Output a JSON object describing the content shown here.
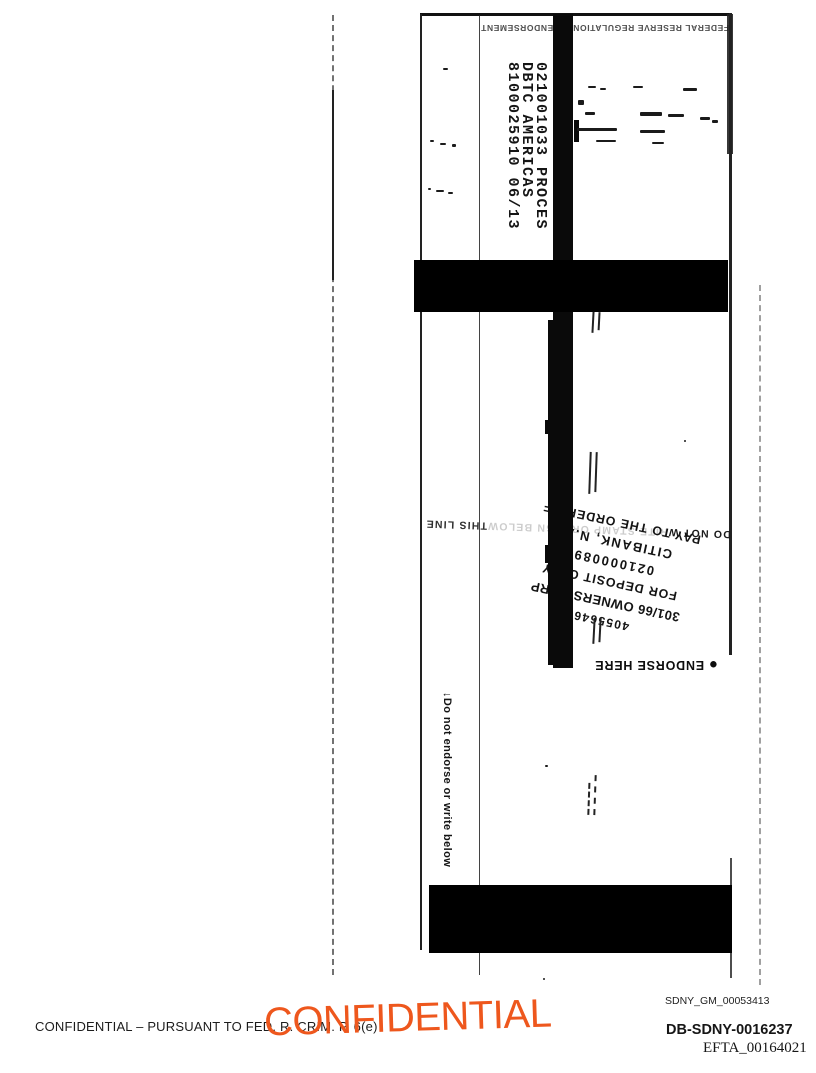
{
  "check_scan": {
    "endorsement_block": {
      "line1": "021001033  PROCES",
      "line2": "DBTC AMERICAS",
      "line3": "8100025910  06/13"
    },
    "top_fine_print": "FEDERAL RESERVE REGULATION CC ENDORSEMENT",
    "do_not_write_line": {
      "start": "DO NOT W",
      "middle": "RITE STAMP OR SIGN BELOW",
      "end": "THIS LINE"
    },
    "deposit_stamp": {
      "line1": "PAY TO THE ORDER OF",
      "line2": "CITIBANK, N.A",
      "line3": "021000089",
      "line4": "FOR DEPOSIT ONLY",
      "line5": "301/66 OWNERS CORP",
      "line6": "4055646"
    },
    "endorse_here": {
      "bullet": "●",
      "label": "ENDORSE HERE"
    },
    "edge_note": "↓Do not endorse or write below"
  },
  "footer": {
    "confidential_stamp": "CONFIDENTIAL",
    "confidential_stamp_color": "#EE571D",
    "legend": "CONFIDENTIAL – PURSUANT TO FED. R. CRIM. P. 6(e)",
    "bates": {
      "sdny_gm": "SDNY_GM_00053413",
      "db_sdny": "DB-SDNY-0016237",
      "efta": "EFTA_00164021"
    }
  }
}
